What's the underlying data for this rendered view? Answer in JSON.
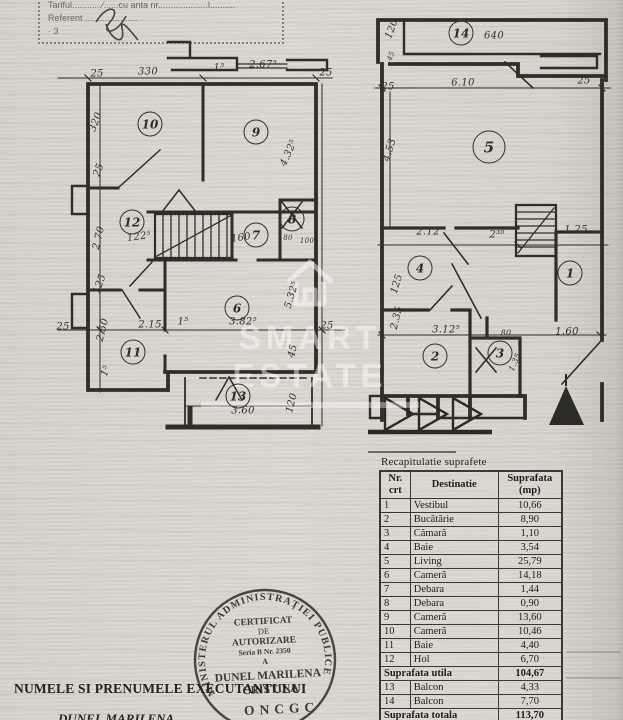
{
  "corner_box": {
    "lines": [
      "Tariful............⁄......cu      anta nr....................l..........",
      "Referent .....................",
      "· 3"
    ]
  },
  "watermark": {
    "text": "SMART ESTATE",
    "icon": "house-icon"
  },
  "plan_left": {
    "rooms": [
      {
        "n": "10",
        "x": 150,
        "y": 124
      },
      {
        "n": "9",
        "x": 256,
        "y": 132
      },
      {
        "n": "12",
        "x": 132,
        "y": 222
      },
      {
        "n": "7",
        "x": 256,
        "y": 235
      },
      {
        "n": "8",
        "x": 292,
        "y": 219
      },
      {
        "n": "6",
        "x": 237,
        "y": 308
      },
      {
        "n": "11",
        "x": 133,
        "y": 352
      },
      {
        "n": "13",
        "x": 238,
        "y": 396
      }
    ],
    "labels": [
      {
        "t": "25",
        "x": 97,
        "y": 74
      },
      {
        "t": "330",
        "x": 148,
        "y": 72
      },
      {
        "t": "1⁵",
        "x": 219,
        "y": 68
      },
      {
        "t": "2.67⁵",
        "x": 263,
        "y": 65
      },
      {
        "t": "25",
        "x": 326,
        "y": 73
      },
      {
        "t": "320",
        "x": 96,
        "y": 122,
        "r": -70
      },
      {
        "t": "25",
        "x": 99,
        "y": 170,
        "r": -70
      },
      {
        "t": "2.70",
        "x": 99,
        "y": 238,
        "r": -76
      },
      {
        "t": "125",
        "x": 100,
        "y": 284,
        "r": -70
      },
      {
        "t": "2.50",
        "x": 103,
        "y": 330,
        "r": -76
      },
      {
        "t": "1⁵",
        "x": 106,
        "y": 371,
        "r": -70
      },
      {
        "t": "25",
        "x": 63,
        "y": 327
      },
      {
        "t": "122⁵",
        "x": 139,
        "y": 237,
        "r": -8
      },
      {
        "t": "160",
        "x": 241,
        "y": 238,
        "r": -8
      },
      {
        "t": "80",
        "x": 288,
        "y": 238,
        "s": 7
      },
      {
        "t": "100",
        "x": 307,
        "y": 241,
        "s": 7
      },
      {
        "t": "2.15",
        "x": 150,
        "y": 325
      },
      {
        "t": "1⁵",
        "x": 183,
        "y": 322
      },
      {
        "t": "3.82⁵",
        "x": 243,
        "y": 322
      },
      {
        "t": "25",
        "x": 327,
        "y": 326
      },
      {
        "t": "4.32⁵",
        "x": 289,
        "y": 153,
        "r": -66
      },
      {
        "t": "5.32⁵",
        "x": 292,
        "y": 295,
        "r": -73
      },
      {
        "t": "45",
        "x": 293,
        "y": 351,
        "r": -76
      },
      {
        "t": "3.60",
        "x": 243,
        "y": 411
      },
      {
        "t": "120",
        "x": 292,
        "y": 403,
        "r": -76
      }
    ]
  },
  "plan_right": {
    "rooms": [
      {
        "n": "14",
        "x": 461,
        "y": 33
      },
      {
        "n": "5",
        "x": 489,
        "y": 147,
        "big": true
      },
      {
        "n": "4",
        "x": 420,
        "y": 268
      },
      {
        "n": "1",
        "x": 570,
        "y": 273
      },
      {
        "n": "2",
        "x": 435,
        "y": 356
      },
      {
        "n": "3",
        "x": 500,
        "y": 353
      }
    ],
    "labels": [
      {
        "t": "640",
        "x": 494,
        "y": 36
      },
      {
        "t": "120",
        "x": 392,
        "y": 29,
        "r": -70
      },
      {
        "t": "45",
        "x": 391,
        "y": 56,
        "r": -70,
        "s": 7
      },
      {
        "t": "6.10",
        "x": 463,
        "y": 83
      },
      {
        "t": "25",
        "x": 388,
        "y": 87
      },
      {
        "t": "25",
        "x": 584,
        "y": 81
      },
      {
        "t": "4.53",
        "x": 390,
        "y": 150,
        "r": -73
      },
      {
        "t": "2.12",
        "x": 428,
        "y": 232
      },
      {
        "t": "2³⁰",
        "x": 497,
        "y": 235
      },
      {
        "t": "1.25",
        "x": 576,
        "y": 230
      },
      {
        "t": "125",
        "x": 397,
        "y": 284,
        "r": -73
      },
      {
        "t": "2.35",
        "x": 397,
        "y": 318,
        "r": -76
      },
      {
        "t": "3.12⁵",
        "x": 446,
        "y": 330
      },
      {
        "t": "80",
        "x": 506,
        "y": 333,
        "s": 8
      },
      {
        "t": "1.60",
        "x": 567,
        "y": 332
      },
      {
        "t": "1.35",
        "x": 515,
        "y": 362,
        "r": -66,
        "s": 8
      }
    ]
  },
  "table": {
    "title": "Recapitulatie suprafete",
    "headers": [
      "Nr.\ncrt",
      "Destinatie",
      "Suprafata\n(mp)"
    ],
    "rows": [
      {
        "nr": "1",
        "dest": "Vestibul",
        "val": "10,66"
      },
      {
        "nr": "2",
        "dest": "Bucătărie",
        "val": "8,90"
      },
      {
        "nr": "3",
        "dest": "Cămară",
        "val": "1,10"
      },
      {
        "nr": "4",
        "dest": "Baie",
        "val": "3,54"
      },
      {
        "nr": "5",
        "dest": "Living",
        "val": "25,79"
      },
      {
        "nr": "6",
        "dest": "Cameră",
        "val": "14,18"
      },
      {
        "nr": "7",
        "dest": "Debara",
        "val": "1,44"
      },
      {
        "nr": "8",
        "dest": "Debara",
        "val": "0,90"
      },
      {
        "nr": "9",
        "dest": "Cameră",
        "val": "13,60"
      },
      {
        "nr": "10",
        "dest": "Cameră",
        "val": "10,46"
      },
      {
        "nr": "11",
        "dest": "Baie",
        "val": "4,40"
      },
      {
        "nr": "12",
        "dest": "Hol",
        "val": "6,70"
      },
      {
        "dest": "Suprafata utila",
        "val": "104,67",
        "span": true
      },
      {
        "nr": "13",
        "dest": "Balcon",
        "val": "4,33"
      },
      {
        "nr": "14",
        "dest": "Balcon",
        "val": "7,70"
      },
      {
        "dest": "Suprafata totala",
        "val": "113,70",
        "span": true
      }
    ]
  },
  "stamp": {
    "ring_text": "MINISTERUL ADMINISTRAȚIEI PUBLICE",
    "lines": [
      "CERTIFICAT",
      "DE",
      "AUTORIZARE",
      "Seria B Nr. 2350",
      "A"
    ],
    "name": [
      "DUNEL MARILENA",
      "CRISTINA"
    ],
    "org": "ONCGC"
  },
  "footer": {
    "line1": "NUMELE SI PRENUMELE EXECUTANTULUI",
    "line2": "DUNEL MARILENA"
  }
}
